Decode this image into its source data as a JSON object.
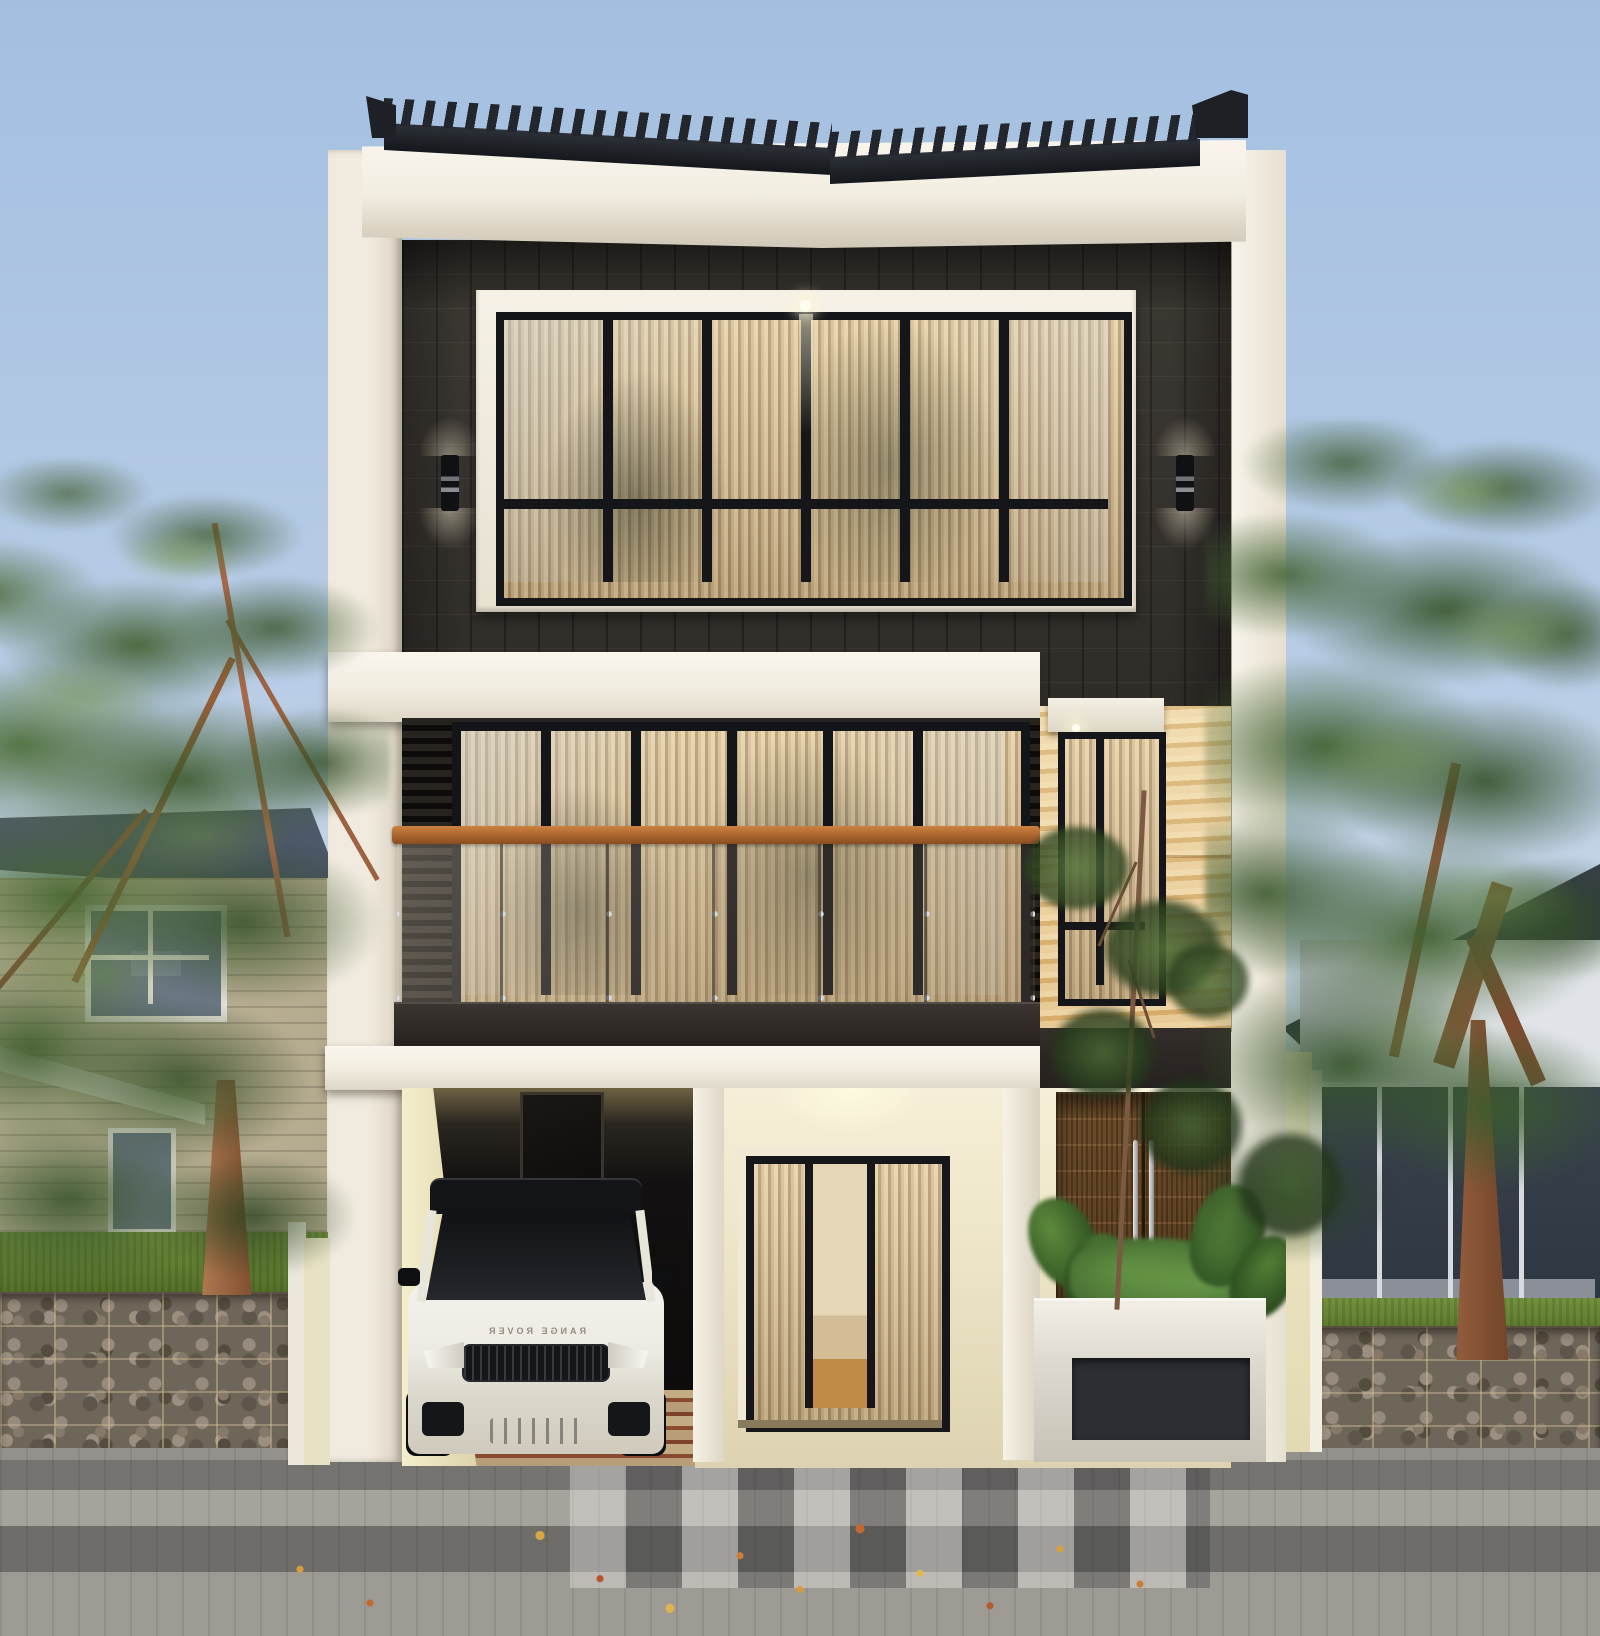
{
  "scene": {
    "objects": [
      "sky",
      "left-neighbor-house",
      "right-neighbor-house",
      "left-tree",
      "right-tree",
      "gabion-fence",
      "paver-sidewalk",
      "fallen-leaves",
      "main-house",
      "sawtooth-roof",
      "white-fascia",
      "side-fin-walls",
      "third-floor-window",
      "wall-sconces",
      "balcony",
      "sliding-glass-doors",
      "travertine-wall",
      "travertine-window",
      "carport",
      "range-rover-car",
      "entry-glass-door",
      "wooden-double-door",
      "planter-box",
      "tropical-plants",
      "small-tree"
    ]
  },
  "car": {
    "badge": "RANGE ROVER"
  },
  "palette": {
    "sky_top": "#a3bfe0",
    "sky_horizon": "#e3e6ea",
    "roof_black": "#23272d",
    "fascia_white": "#f2ede1",
    "fin_white": "#f1ebdf",
    "wall_charcoal": "#38342f",
    "slat_dark": "#1d1a17",
    "travertine": "#ecd3a2",
    "travertine_deep": "#dfb778",
    "wood_rail": "#b06a32",
    "parapet_dark": "#322d29",
    "slab_white": "#f1ecdf",
    "porch_warm": "#efe7c9",
    "planter_recess": "#2b2e33",
    "gabion_stone": "#6f665a",
    "gabion_mesh": "#cdbA94",
    "paver_light": "#a6a39c",
    "paver_dark": "#6e6d69",
    "grass_green": "#4e6b27",
    "leaf_green": "#4c7433",
    "leaf_dark": "#2c451f",
    "trunk_brown": "#9a6242",
    "curtain_warm": "#e5cfa4",
    "curtain_shadow": "#a98f66",
    "window_black": "#15161a",
    "car_white": "#eceae2",
    "neighbor_left_wall": "#c9bda0",
    "neighbor_left_roof": "#46505e",
    "neighbor_right_wall": "#e0e3e7",
    "neighbor_right_roof": "#2c333d"
  }
}
